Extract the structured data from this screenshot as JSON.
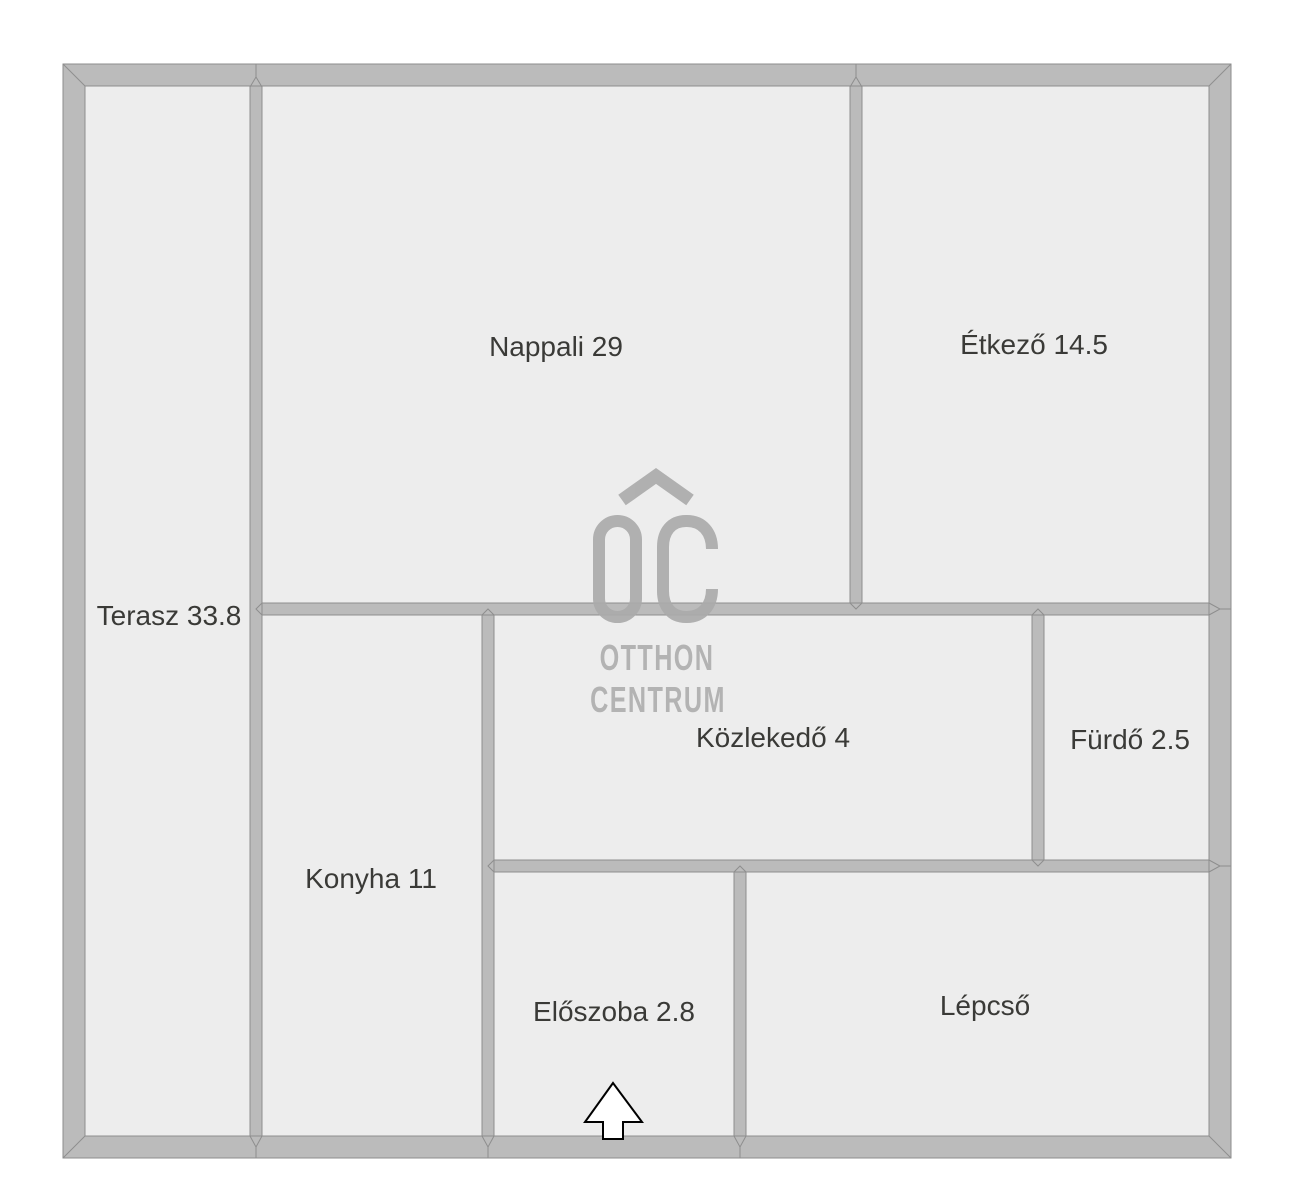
{
  "branding": {
    "logo_monogram": "OC",
    "logo_top": "OTTHON",
    "logo_bottom": "CENTRUM"
  },
  "rooms": [
    {
      "name": "Terasz",
      "area": "33.8",
      "label": "Terasz 33.8"
    },
    {
      "name": "Nappali",
      "area": "29",
      "label": "Nappali 29"
    },
    {
      "name": "Étkező",
      "area": "14.5",
      "label": "Étkező 14.5"
    },
    {
      "name": "Konyha",
      "area": "11",
      "label": "Konyha 11"
    },
    {
      "name": "Közlekedő",
      "area": "4",
      "label": "Közlekedő 4"
    },
    {
      "name": "Fürdő",
      "area": "2.5",
      "label": "Fürdő 2.5"
    },
    {
      "name": "Előszoba",
      "area": "2.8",
      "label": "Előszoba 2.8"
    },
    {
      "name": "Lépcső",
      "area": "",
      "label": "Lépcső"
    }
  ],
  "colors": {
    "wall": "#bbbbbb",
    "wall_outline": "#8e8e8e",
    "room_fill": "#ededed",
    "label_text": "#3a3a37",
    "logo": "#ababab",
    "logo_text": "#b3b3b3",
    "background": "#ffffff",
    "arrow_fill": "#ffffff",
    "arrow_outline": "#000000"
  }
}
